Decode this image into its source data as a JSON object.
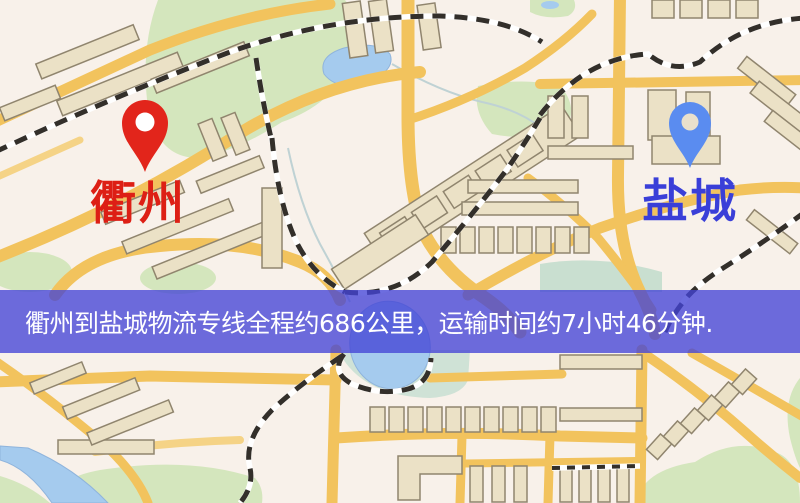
{
  "banner": {
    "text": "衢州到盐城物流专线全程约686公里，运输时间约7小时46分钟.",
    "origin": "衢州",
    "destination": "盐城",
    "distance_km": "686公里",
    "duration": "7小时46分钟",
    "bg_rgba": "rgba(68,68,214,0.78)",
    "text_color": "#ffffff"
  },
  "markers": {
    "origin": {
      "label": "衢州",
      "pin_color": "#e2251b",
      "pin_hole_color": "#ffffff",
      "label_color": "#dd1f15",
      "icon": "map-pin-icon"
    },
    "destination": {
      "label": "盐城",
      "pin_color": "#5a8cf0",
      "pin_hole_color": "#e9e0cc",
      "label_color": "#3a3fd8",
      "icon": "map-pin-icon"
    }
  },
  "map_palette": {
    "background": "#f8f1ea",
    "road": "#f2c35d",
    "road_minor": "#f5d386",
    "water": "#a5cbee",
    "park_green": "#d4e6bd",
    "building": "#ebe1c6",
    "railway": "#332f2a"
  }
}
